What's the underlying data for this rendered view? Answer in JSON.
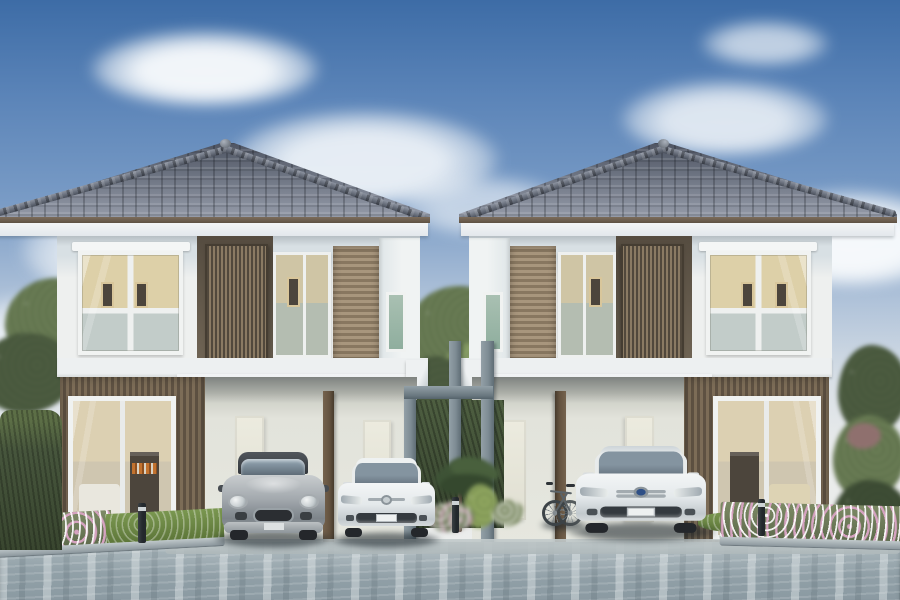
{
  "meta": {
    "type": "architectural-exterior-rendering",
    "description": "Photorealistic rendering of two identical two-storey detached houses with hipped grey tile roofs, brown timber-slat accents, ground-floor carports with parked cars, a bicycle, a grey pergola gate between the houses, landscaped flower beds, hedges, trees and a blue-grey paved driveway under a blue sky with soft clouds",
    "time_of_day": "day",
    "visible_text": "none"
  },
  "palette": {
    "sky_top": "#3d6ca6",
    "sky_mid": "#7a9cc6",
    "sky_low": "#d9e0e6",
    "roof_dark": "#4c5260",
    "roof_mid": "#6d7482",
    "roof_light": "#979dab",
    "fascia": "#7c6c5b",
    "soffit": "#e3e8ec",
    "wall": "#eef0ef",
    "wall_band": "#d8e0e4",
    "wood_mid": "#7c6c57",
    "wood_light": "#a8967d",
    "glass_warm": "#ddd0a8",
    "glass_cool": "#c2ccc9",
    "interior_dark": "#4c453c",
    "accent_orange": "#c1722f",
    "floor_white": "#edf0f1",
    "carport": "#dfe0d8",
    "door": "#ecebdf",
    "post": "#63523f",
    "pergola": "#7e8c94",
    "pergola_dark": "#5f6d75",
    "tree": "#6a7d55",
    "tree_dark": "#4d5d41",
    "tree_light": "#8aa068",
    "hedge": "#46553c",
    "grass": "#7a9750",
    "flower_pink": "#d5a3c0",
    "flower_white": "#f2f3ee",
    "pave": "#93a2a9",
    "car_silver": "#a3a9ae",
    "car_dark": "#33373c",
    "car_white": "#e4e9eb",
    "car_glass": "#66737f"
  },
  "scene": {
    "houses": [
      {
        "id": "house-left",
        "storeys": 2,
        "roof": "hipped grey tile with finial",
        "upper_floor": [
          "white framed picture window with roller shade",
          "vertical timber louvre screen",
          "sliding window",
          "horizontal timber slat cladding",
          "narrow side window"
        ],
        "ground_floor": [
          "timber slat wall with large sliding glass door",
          "double carport",
          "two cream service doors",
          "timber post"
        ],
        "interior_glimpse": [
          "white sofa",
          "dark shelf with orange books",
          "framed pictures"
        ]
      },
      {
        "id": "house-right",
        "mirrored": true,
        "storeys": 2,
        "roof": "hipped grey tile with finial",
        "ground_floor": [
          "double carport",
          "sliding glass door with beige sofa visible"
        ]
      }
    ],
    "vehicles": [
      {
        "id": "hatchback",
        "style": "mini-style hatchback",
        "color": "silver with dark roof",
        "location": "left house carport, left bay"
      },
      {
        "id": "sedan-small",
        "style": "compact sedan",
        "color": "white",
        "location": "left house carport, right bay"
      },
      {
        "id": "sedan-large",
        "style": "full-size sedan",
        "color": "white, blue emblem",
        "location": "right house carport"
      }
    ],
    "bicycle": {
      "color": "grey",
      "location": "leaning at right-house carport post"
    },
    "pergola_gate": {
      "color": "grey",
      "parts": [
        "left pillar",
        "centre post",
        "right pillar",
        "horizontal beam"
      ]
    },
    "landscaping": [
      "tall tree left",
      "hedge wall left",
      "flower bed left with white and pink flowers",
      "tree between houses",
      "palm and pink flowers at centre",
      "grass and flower bed right",
      "shrub trees far right"
    ],
    "lights": {
      "bollards": 3
    },
    "ground": "blue-grey streaked concrete driveway with kerbs"
  }
}
